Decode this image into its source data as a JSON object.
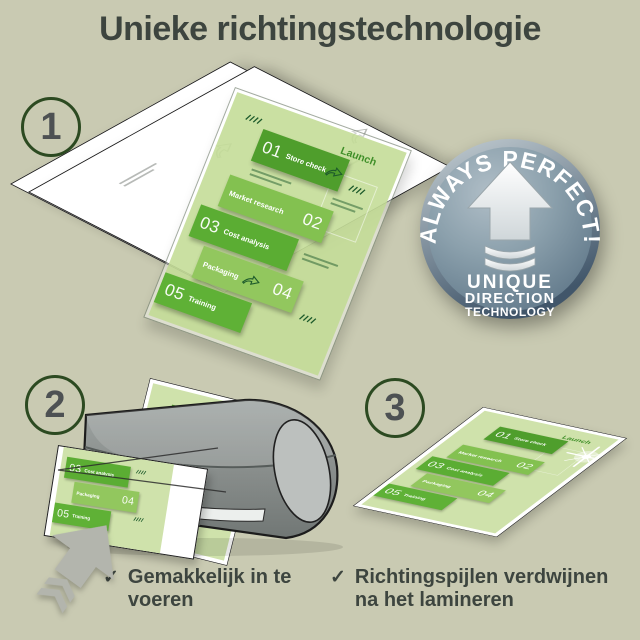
{
  "title": "Unieke richtingstechnologie",
  "steps": [
    {
      "number": "1"
    },
    {
      "number": "2"
    },
    {
      "number": "3"
    }
  ],
  "badge": {
    "arc_text": "ALWAYS PERFECT!",
    "lines": [
      "UNIQUE",
      "DIRECTION",
      "TECHNOLOGY"
    ]
  },
  "document": {
    "launch_label": "Launch",
    "items": [
      {
        "num": "01",
        "label": "Store check"
      },
      {
        "num": "02",
        "label": "Market research"
      },
      {
        "num": "03",
        "label": "Cost analysis"
      },
      {
        "num": "04",
        "label": "Packaging"
      },
      {
        "num": "05",
        "label": "Training"
      }
    ]
  },
  "checklist": [
    {
      "mark": "✓",
      "text": "Gemakkelijk in te voeren"
    },
    {
      "mark": "✓",
      "text": "Richtingspijlen verdwijnen na het lamineren"
    }
  ],
  "colors": {
    "background": "#c9cab2",
    "ink": "#3d453f",
    "step_ring": "#2c4a21",
    "step_number": "#4d5153",
    "page_green": "#cfe2ab",
    "block_green_1": "#4f9e2c",
    "block_green_2": "#83c150",
    "block_green_3": "#5bad33",
    "block_green_4": "#92c75e",
    "block_green_5": "#5fb136",
    "launch_green": "#3f8f28",
    "print_green_dark": "#1d5a2b",
    "badge_face": "#7f95a4",
    "badge_rim": "#52677a",
    "badge_white": "#f5f7f6",
    "machine_gray": "#878c8a",
    "machine_cap": "#bcc0be",
    "arrow_gray": "#b3b5ad"
  }
}
